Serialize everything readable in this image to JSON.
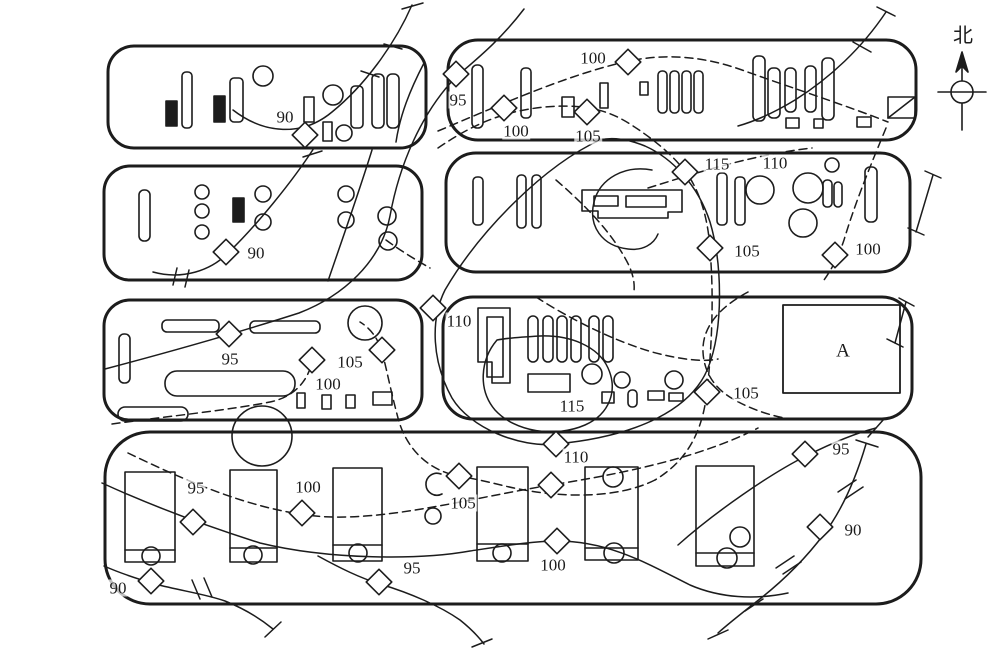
{
  "colors": {
    "ink": "#1c1c1c",
    "paper": "#ffffff"
  },
  "contour_levels": [
    90,
    95,
    100,
    105,
    110,
    115
  ],
  "compass": {
    "label": "北"
  },
  "building_a": {
    "label": "A"
  },
  "contour_labels": [
    {
      "name": "contour-label-90",
      "text": "90",
      "x": 285,
      "y": 117
    },
    {
      "name": "contour-label-95",
      "text": "95",
      "x": 458,
      "y": 100
    },
    {
      "name": "contour-label-100",
      "text": "100",
      "x": 593,
      "y": 58
    },
    {
      "name": "contour-label-100",
      "text": "100",
      "x": 516,
      "y": 131
    },
    {
      "name": "contour-label-105",
      "text": "105",
      "x": 588,
      "y": 136
    },
    {
      "name": "contour-label-115",
      "text": "115",
      "x": 717,
      "y": 164
    },
    {
      "name": "contour-label-110",
      "text": "110",
      "x": 775,
      "y": 163
    },
    {
      "name": "contour-label-90",
      "text": "90",
      "x": 256,
      "y": 253
    },
    {
      "name": "contour-label-105",
      "text": "105",
      "x": 747,
      "y": 251
    },
    {
      "name": "contour-label-100",
      "text": "100",
      "x": 868,
      "y": 249
    },
    {
      "name": "contour-label-95",
      "text": "95",
      "x": 230,
      "y": 359
    },
    {
      "name": "contour-label-105",
      "text": "105",
      "x": 350,
      "y": 362
    },
    {
      "name": "contour-label-100",
      "text": "100",
      "x": 328,
      "y": 384
    },
    {
      "name": "contour-label-110",
      "text": "110",
      "x": 459,
      "y": 321
    },
    {
      "name": "contour-label-115",
      "text": "115",
      "x": 572,
      "y": 406
    },
    {
      "name": "contour-label-105",
      "text": "105",
      "x": 746,
      "y": 393
    },
    {
      "name": "contour-label-110",
      "text": "110",
      "x": 576,
      "y": 457
    },
    {
      "name": "contour-label-105",
      "text": "105",
      "x": 463,
      "y": 503
    },
    {
      "name": "contour-label-95",
      "text": "95",
      "x": 196,
      "y": 488
    },
    {
      "name": "contour-label-100",
      "text": "100",
      "x": 308,
      "y": 487
    },
    {
      "name": "contour-label-100",
      "text": "100",
      "x": 553,
      "y": 565
    },
    {
      "name": "contour-label-95",
      "text": "95",
      "x": 412,
      "y": 568
    },
    {
      "name": "contour-label-90",
      "text": "90",
      "x": 118,
      "y": 588
    },
    {
      "name": "contour-label-95",
      "text": "95",
      "x": 841,
      "y": 449
    },
    {
      "name": "contour-label-90",
      "text": "90",
      "x": 853,
      "y": 530
    },
    {
      "name": "building-a-label",
      "text": "A",
      "x": 843,
      "y": 351,
      "size": 19
    },
    {
      "name": "north-label",
      "text": "北",
      "x": 963,
      "y": 36,
      "size": 20
    }
  ],
  "markers": [
    {
      "x": 305,
      "y": 135
    },
    {
      "x": 456,
      "y": 74
    },
    {
      "x": 504,
      "y": 108
    },
    {
      "x": 587,
      "y": 112
    },
    {
      "x": 628,
      "y": 62
    },
    {
      "x": 685,
      "y": 172
    },
    {
      "x": 710,
      "y": 248
    },
    {
      "x": 835,
      "y": 255
    },
    {
      "x": 226,
      "y": 252
    },
    {
      "x": 229,
      "y": 334
    },
    {
      "x": 312,
      "y": 360
    },
    {
      "x": 382,
      "y": 350
    },
    {
      "x": 433,
      "y": 308
    },
    {
      "x": 707,
      "y": 392
    },
    {
      "x": 556,
      "y": 444
    },
    {
      "x": 551,
      "y": 485
    },
    {
      "x": 459,
      "y": 476
    },
    {
      "x": 557,
      "y": 541
    },
    {
      "x": 193,
      "y": 522
    },
    {
      "x": 302,
      "y": 513
    },
    {
      "x": 379,
      "y": 582
    },
    {
      "x": 151,
      "y": 581
    },
    {
      "x": 805,
      "y": 454
    },
    {
      "x": 820,
      "y": 527
    }
  ]
}
